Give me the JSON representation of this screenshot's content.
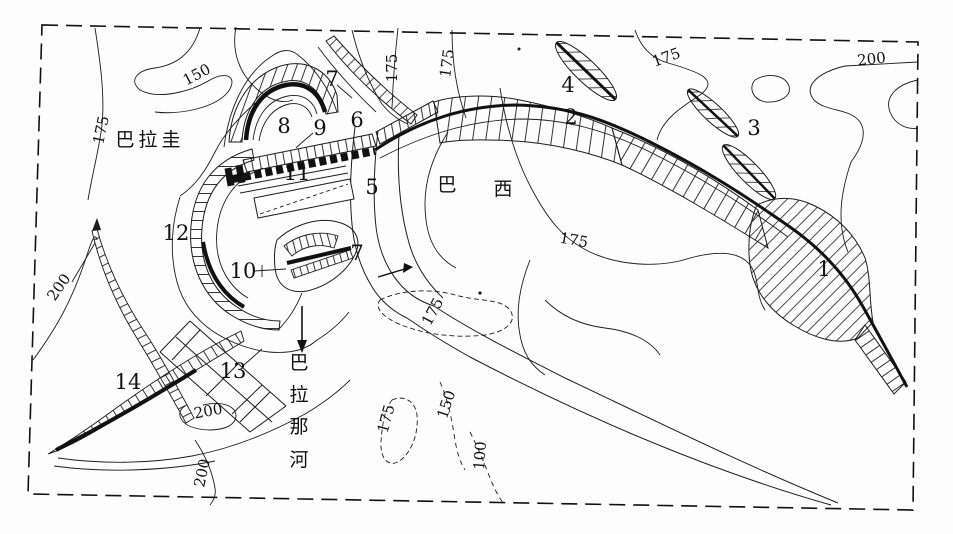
{
  "map": {
    "colors": {
      "ink": "#1c1c1c",
      "paper": "#ffffff"
    },
    "regions": {
      "paraguay": {
        "text": "巴拉圭"
      },
      "brazil": {
        "chars": [
          "巴",
          "西"
        ]
      },
      "river": {
        "name": "巴拉那河",
        "chars": [
          "巴",
          "拉",
          "那",
          "河"
        ]
      }
    },
    "markers": [
      {
        "label": "1"
      },
      {
        "label": "2"
      },
      {
        "label": "3"
      },
      {
        "label": "4"
      },
      {
        "label": "5"
      },
      {
        "label": "6"
      },
      {
        "label": "7"
      },
      {
        "label": "8"
      },
      {
        "label": "9"
      },
      {
        "label": "10"
      },
      {
        "label": "11"
      },
      {
        "label": "12"
      },
      {
        "label": "13"
      },
      {
        "label": "14"
      },
      {
        "label": "7"
      }
    ],
    "contour_labels": [
      {
        "value": "175"
      },
      {
        "value": "150"
      },
      {
        "value": "175"
      },
      {
        "value": "175"
      },
      {
        "value": "175"
      },
      {
        "value": "200"
      },
      {
        "value": "200"
      },
      {
        "value": "175"
      },
      {
        "value": "175"
      },
      {
        "value": "175"
      },
      {
        "value": "150"
      },
      {
        "value": "100"
      },
      {
        "value": "200"
      },
      {
        "value": "200"
      }
    ]
  }
}
